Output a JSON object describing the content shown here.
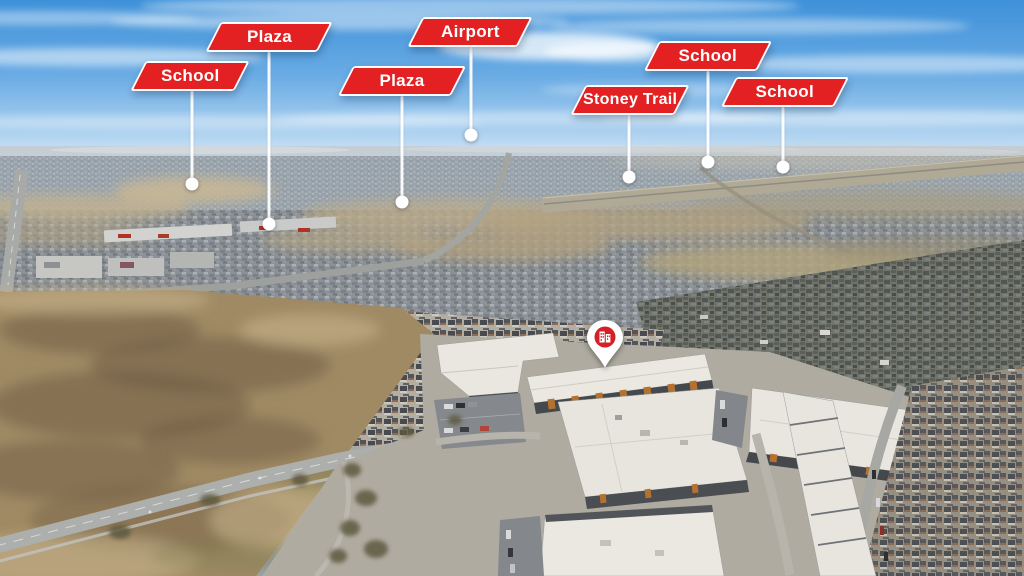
{
  "scene": {
    "kind": "annotated aerial neighbourhood photo",
    "sky": "blue with thin clouds",
    "ground": "prairie suburbs, condo complex in foreground"
  },
  "colors": {
    "label_red": "#e32122",
    "label_border": "#ffffff",
    "label_text": "#ffffff",
    "leader_line": "#ffffff",
    "location_dot": "#ffffff",
    "pin_body": "#ffffff",
    "pin_badge_red": "#d42026",
    "sky_top": "#3e91d9",
    "sky_horizon": "#dcebf8",
    "far_suburb": "#99a3ab",
    "mid_suburb": "#8b9196",
    "near_suburb": "#6f7369",
    "field_tan": "#9f8a64",
    "road_gray": "#adafad",
    "condo_roof": "#eae8e1",
    "condo_accent_orange": "#b5722f"
  },
  "markers": [
    {
      "label": "School",
      "dot": {
        "x": 192,
        "y": 184
      },
      "label_top": 61,
      "width": 104,
      "offset_x": -2
    },
    {
      "label": "Plaza",
      "dot": {
        "x": 269,
        "y": 224
      },
      "label_top": 22,
      "width": 112,
      "offset_x": 0
    },
    {
      "label": "Plaza",
      "dot": {
        "x": 402,
        "y": 202
      },
      "label_top": 66,
      "width": 113,
      "offset_x": 0
    },
    {
      "label": "Airport",
      "dot": {
        "x": 471,
        "y": 135
      },
      "label_top": 17,
      "width": 110,
      "offset_x": -1
    },
    {
      "label": "Stoney Trail",
      "dot": {
        "x": 629,
        "y": 177
      },
      "label_top": 85,
      "width": 104,
      "offset_x": 1
    },
    {
      "label": "School",
      "dot": {
        "x": 708,
        "y": 162
      },
      "label_top": 41,
      "width": 113,
      "offset_x": 0
    },
    {
      "label": "School",
      "dot": {
        "x": 783,
        "y": 167
      },
      "label_top": 77,
      "width": 113,
      "offset_x": 2
    }
  ],
  "pin": {
    "x": 605,
    "tip_y": 369,
    "badge_icon": "building-icon"
  }
}
